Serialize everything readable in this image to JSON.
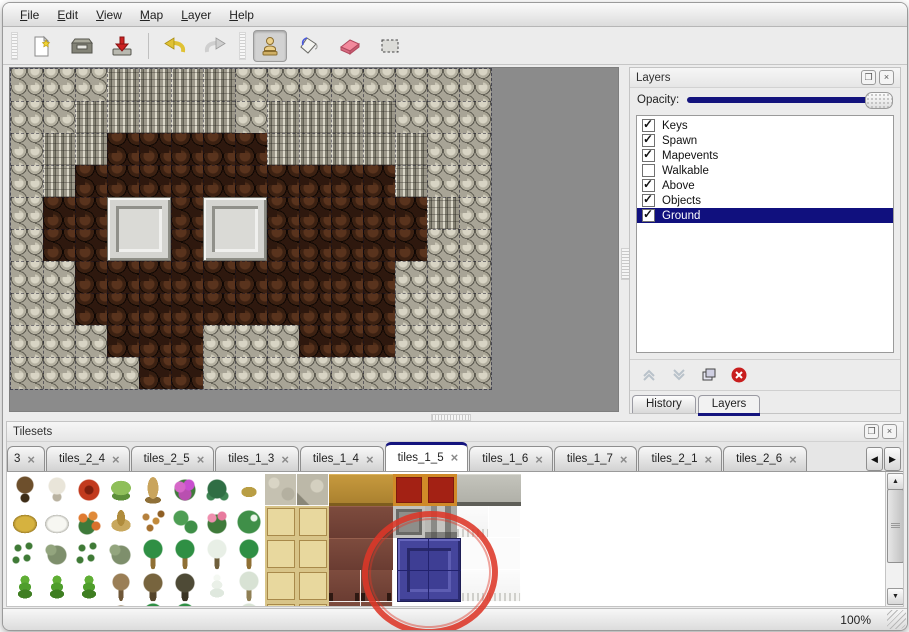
{
  "window": {
    "menu": [
      "File",
      "Edit",
      "View",
      "Map",
      "Layer",
      "Help"
    ],
    "status_zoom": "100%"
  },
  "toolbar": {
    "groups": [
      {
        "buttons": [
          {
            "icon": "new-file"
          },
          {
            "icon": "open"
          },
          {
            "icon": "save"
          }
        ]
      },
      {
        "buttons": [
          {
            "icon": "undo"
          },
          {
            "icon": "redo"
          }
        ]
      },
      {
        "buttons": [
          {
            "icon": "stamp-tool",
            "selected": true
          },
          {
            "icon": "fill-tool"
          },
          {
            "icon": "eraser-tool"
          },
          {
            "icon": "rect-select-tool"
          }
        ]
      }
    ]
  },
  "map": {
    "tile_size": 32,
    "legend": {
      "P": "rock",
      "C": "cliff",
      "F": "floor"
    },
    "grid": [
      "PPPCCCCPPPPPPPP",
      "PPCCCCCPCCCCPPP",
      "PCCFFFFFCCCCCPP",
      "PCFFFFFFFFFFCPP",
      "PFFFFFFFFFFFFCP",
      "PFFFFFFFFFFFFPP",
      "PPFFFFFFFFFFPPP",
      "PPFFFFFFFFFFPPP",
      "PPPFFFPPPFFFPPP",
      "PPPPFFPPPPPPPPP"
    ],
    "blocks": [
      {
        "col": 3,
        "row": 4
      },
      {
        "col": 6,
        "row": 4
      }
    ]
  },
  "layers_panel": {
    "title": "Layers",
    "controls": [
      "float",
      "close"
    ],
    "opacity_label": "Opacity:",
    "opacity_value": 100,
    "layers": [
      {
        "name": "Keys",
        "checked": true
      },
      {
        "name": "Spawn",
        "checked": true
      },
      {
        "name": "Mapevents",
        "checked": true
      },
      {
        "name": "Walkable",
        "checked": false
      },
      {
        "name": "Above",
        "checked": true
      },
      {
        "name": "Objects",
        "checked": true
      },
      {
        "name": "Ground",
        "checked": true,
        "selected": true
      }
    ],
    "actions": [
      {
        "icon": "move-layer-up",
        "disabled": true
      },
      {
        "icon": "move-layer-down",
        "disabled": true
      },
      {
        "icon": "duplicate-layer",
        "disabled": false
      },
      {
        "icon": "delete-layer",
        "disabled": false
      }
    ],
    "tabs": [
      {
        "label": "History"
      },
      {
        "label": "Layers",
        "active": true
      }
    ]
  },
  "tilesets_panel": {
    "title": "Tilesets",
    "controls": [
      "float",
      "close"
    ],
    "tabs": [
      {
        "label": "3",
        "truncated": true
      },
      {
        "label": "tiles_2_4"
      },
      {
        "label": "tiles_2_5"
      },
      {
        "label": "tiles_1_3"
      },
      {
        "label": "tiles_1_4"
      },
      {
        "label": "tiles_1_5",
        "active": true
      },
      {
        "label": "tiles_1_6"
      },
      {
        "label": "tiles_1_7"
      },
      {
        "label": "tiles_2_1"
      },
      {
        "label": "tiles_2_6"
      }
    ],
    "scroll_buttons": [
      "scroll-tabs-left",
      "scroll-tabs-right"
    ],
    "legend": {
      "t1": "dark-tree",
      "t2": "white-tree",
      "fr": "red-flower",
      "st": "green-stump",
      "tk": "tan-trunk",
      "fp": "purple-flowers",
      "fn": "fern",
      "wd": "weed",
      "sn": "stone-tile",
      "sn2": "stone-corner-tile",
      "ta": "tan-wood-tile",
      "ro": "red-ornate-carpet",
      "gr": "gray-tile",
      "hy": "hay-mound",
      "sm": "snow-mound",
      "fo": "orange-flowers",
      "dg": "dry-grass",
      "lv": "leaves",
      "lp": "lily-pads",
      "rs": "rose-bush",
      "lp2": "large-lily-pad",
      "tm": "tatami-tile",
      "mr": "maroon-table",
      "gf": "gray-frame-block",
      "gb": "gray-beams",
      "cw": "white-curtain",
      "cf": "curtain-fringe",
      "sp": "sprouts",
      "bu": "bush",
      "pa": "palm-tree",
      "sw": "snowy-tree",
      "co": "conifer",
      "bt": "bare-tree",
      "gn": "gnarled-tree",
      "dt": "dark-bush-tree",
      "sv": "snow-pine",
      "s2": "snowy-palm",
      "ml": "maroon-table-legs",
      "e": "empty"
    },
    "grid": [
      [
        "t1",
        "t2",
        "fr",
        "st",
        "tk",
        "fp",
        "fn",
        "wd",
        "sn",
        "sn2",
        "ta",
        "ta",
        "ro",
        "ro",
        "gr",
        "gr",
        "e"
      ],
      [
        "hy",
        "sm",
        "fo",
        "dg",
        "lv",
        "lp",
        "rs",
        "lp2",
        "tm",
        "tm",
        "mr",
        "mr",
        "gf",
        "gb",
        "cf",
        "cw",
        "e"
      ],
      [
        "sp",
        "bu",
        "sp",
        "bu",
        "pa",
        "pa",
        "sw",
        "pa",
        "tm",
        "tm",
        "mr",
        "mr",
        "e",
        "e",
        "cw",
        "cw",
        "e"
      ],
      [
        "co",
        "co",
        "co",
        "bt",
        "gn",
        "dt",
        "sv",
        "s2",
        "tm",
        "tm",
        "ml",
        "ml",
        "e",
        "e",
        "cf",
        "cf",
        "e"
      ],
      [
        "co",
        "bu",
        "co",
        "gn",
        "pa",
        "pa",
        "sv",
        "s2",
        "tm",
        "tm",
        "ml",
        "ml",
        "e",
        "e",
        "e",
        "e",
        "e"
      ]
    ],
    "selected_tile": {
      "col": 12,
      "row": 2,
      "span_cols": 2,
      "span_rows": 2,
      "name": "blue-block-tile"
    }
  },
  "annotation": {
    "shape": "circle",
    "color": "#dd3728",
    "target": "blue-block-tile"
  },
  "scrollbar": {
    "up": "scroll-up",
    "down": "scroll-down"
  }
}
